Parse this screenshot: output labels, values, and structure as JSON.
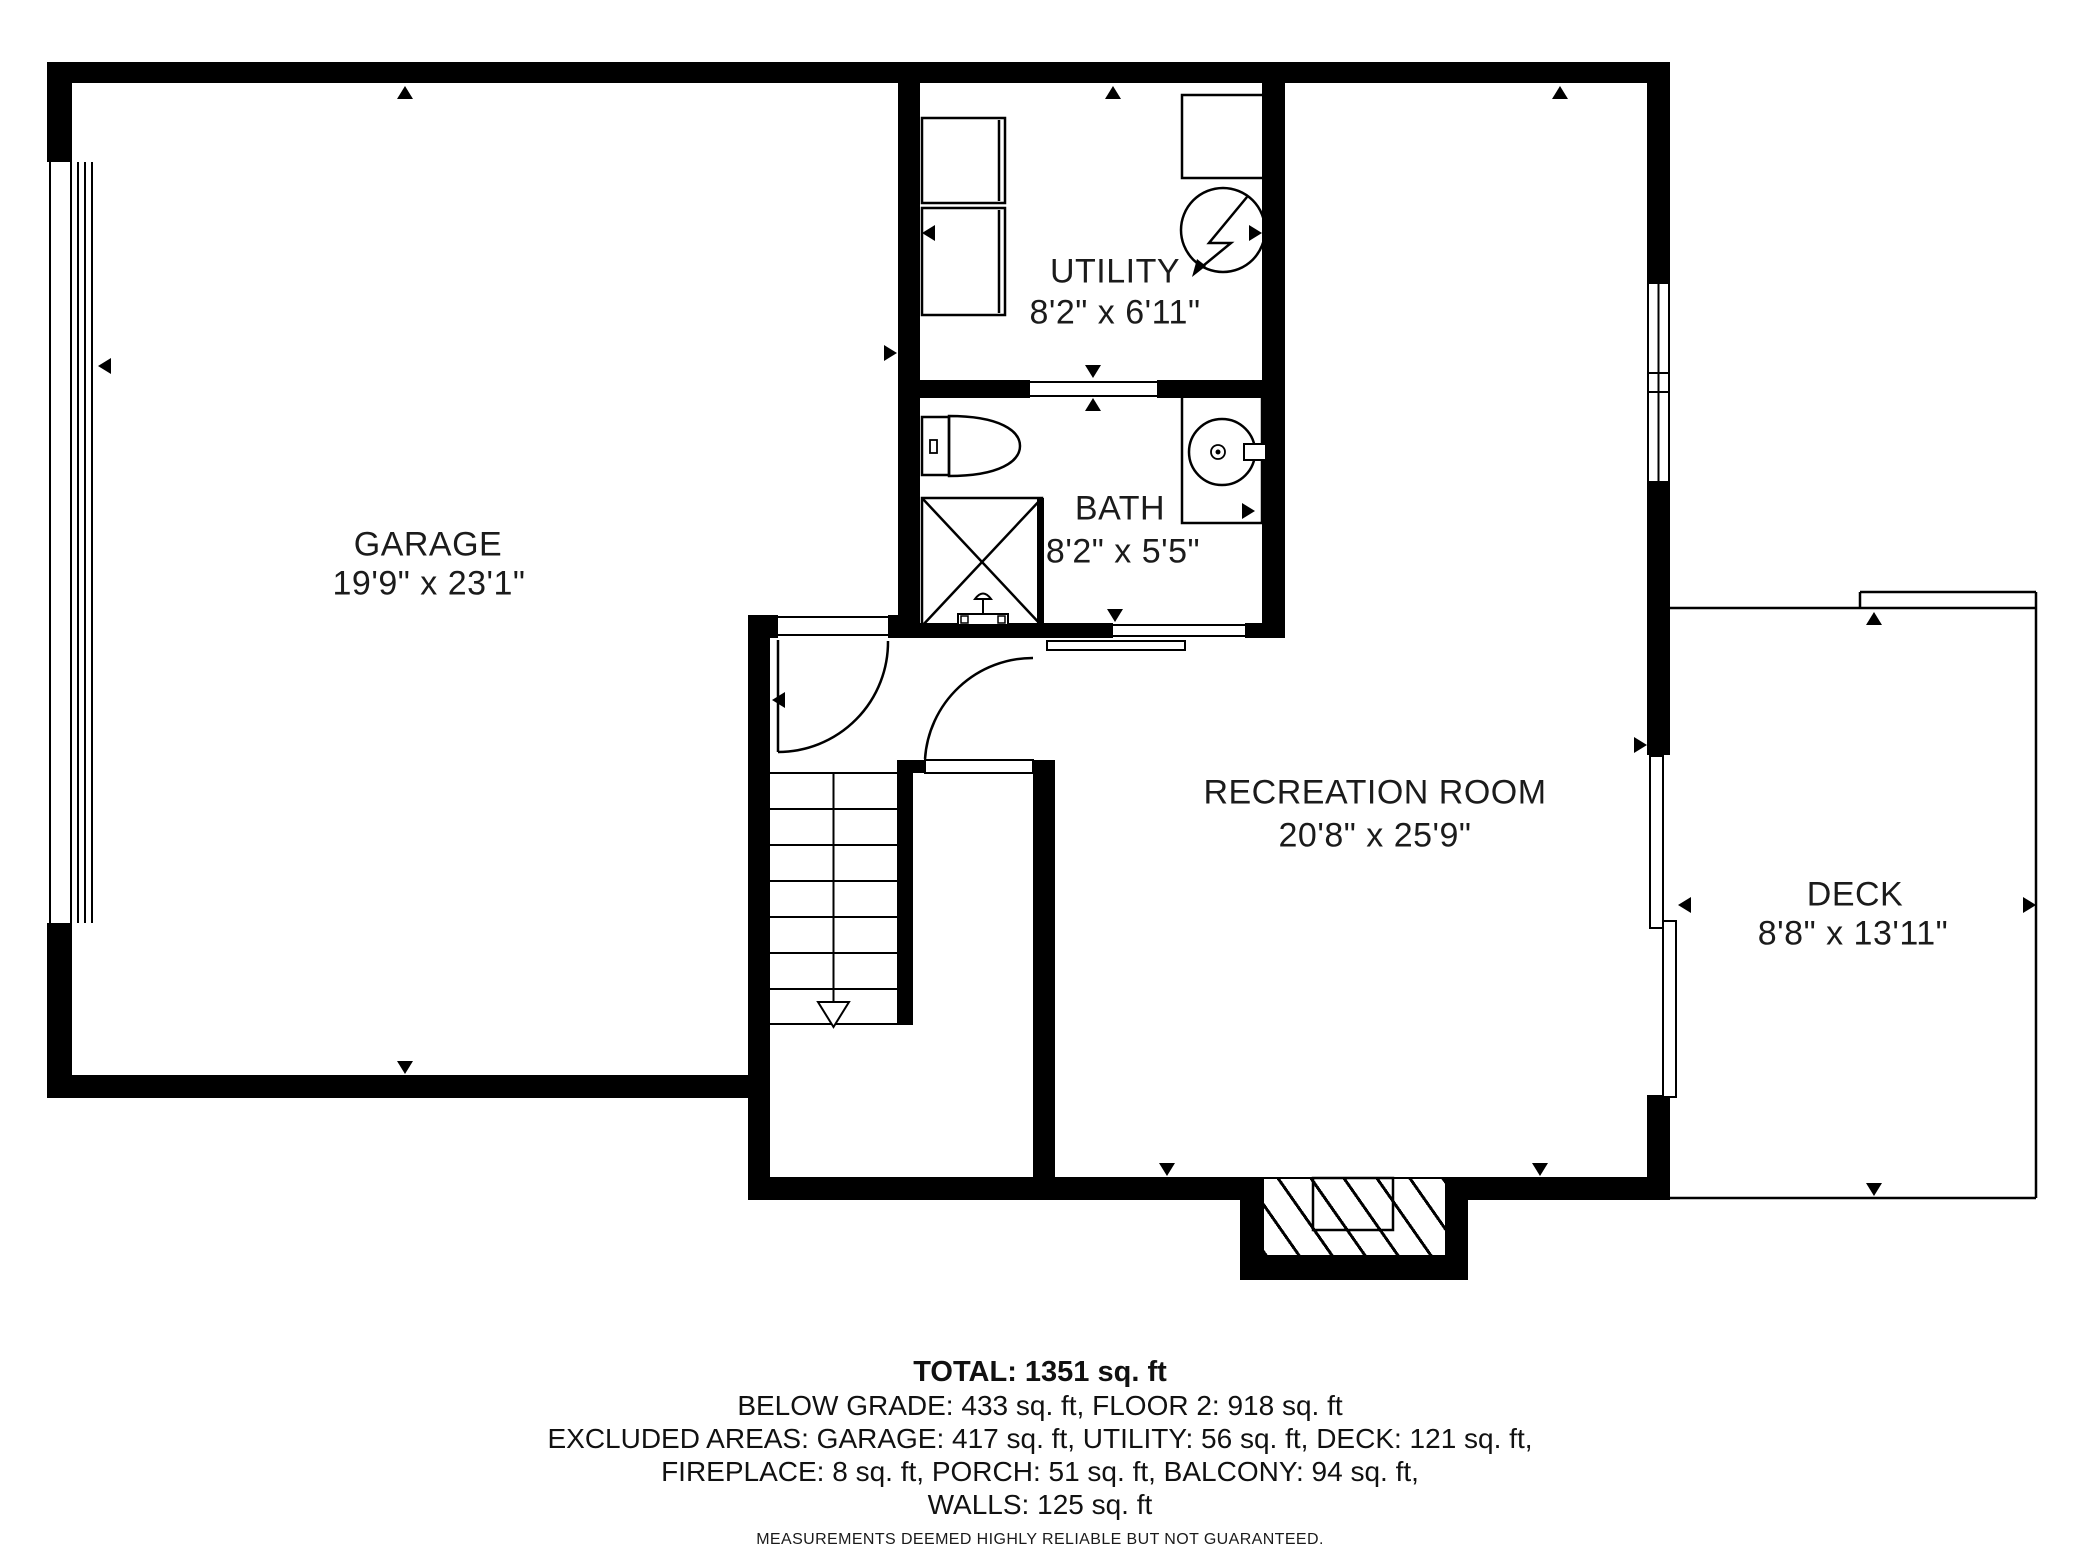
{
  "rooms": [
    {
      "id": "garage",
      "label": "GARAGE",
      "dims": "19'9\" x 23'1\""
    },
    {
      "id": "utility",
      "label": "UTILITY",
      "dims": "8'2\" x 6'11\""
    },
    {
      "id": "bath",
      "label": "BATH",
      "dims": "8'2\" x 5'5\""
    },
    {
      "id": "recreation",
      "label": "RECREATION ROOM",
      "dims": "20'8\" x 25'9\""
    },
    {
      "id": "deck",
      "label": "DECK",
      "dims": "8'8\" x 13'11\""
    }
  ],
  "summary": {
    "total": "TOTAL: 1351 sq. ft",
    "line2": "BELOW GRADE: 433 sq. ft, FLOOR 2: 918 sq. ft",
    "line3": "EXCLUDED AREAS: GARAGE: 417 sq. ft, UTILITY: 56 sq. ft, DECK: 121 sq. ft,",
    "line4": "FIREPLACE: 8 sq. ft, PORCH: 51 sq. ft, BALCONY: 94 sq. ft,",
    "line5": "WALLS: 125 sq. ft",
    "disclaimer": "MEASUREMENTS DEEMED HIGHLY RELIABLE BUT NOT GUARANTEED."
  },
  "colors": {
    "wall": "#000000",
    "line": "#000000",
    "text": "#1b1b1b",
    "background": "#ffffff"
  }
}
